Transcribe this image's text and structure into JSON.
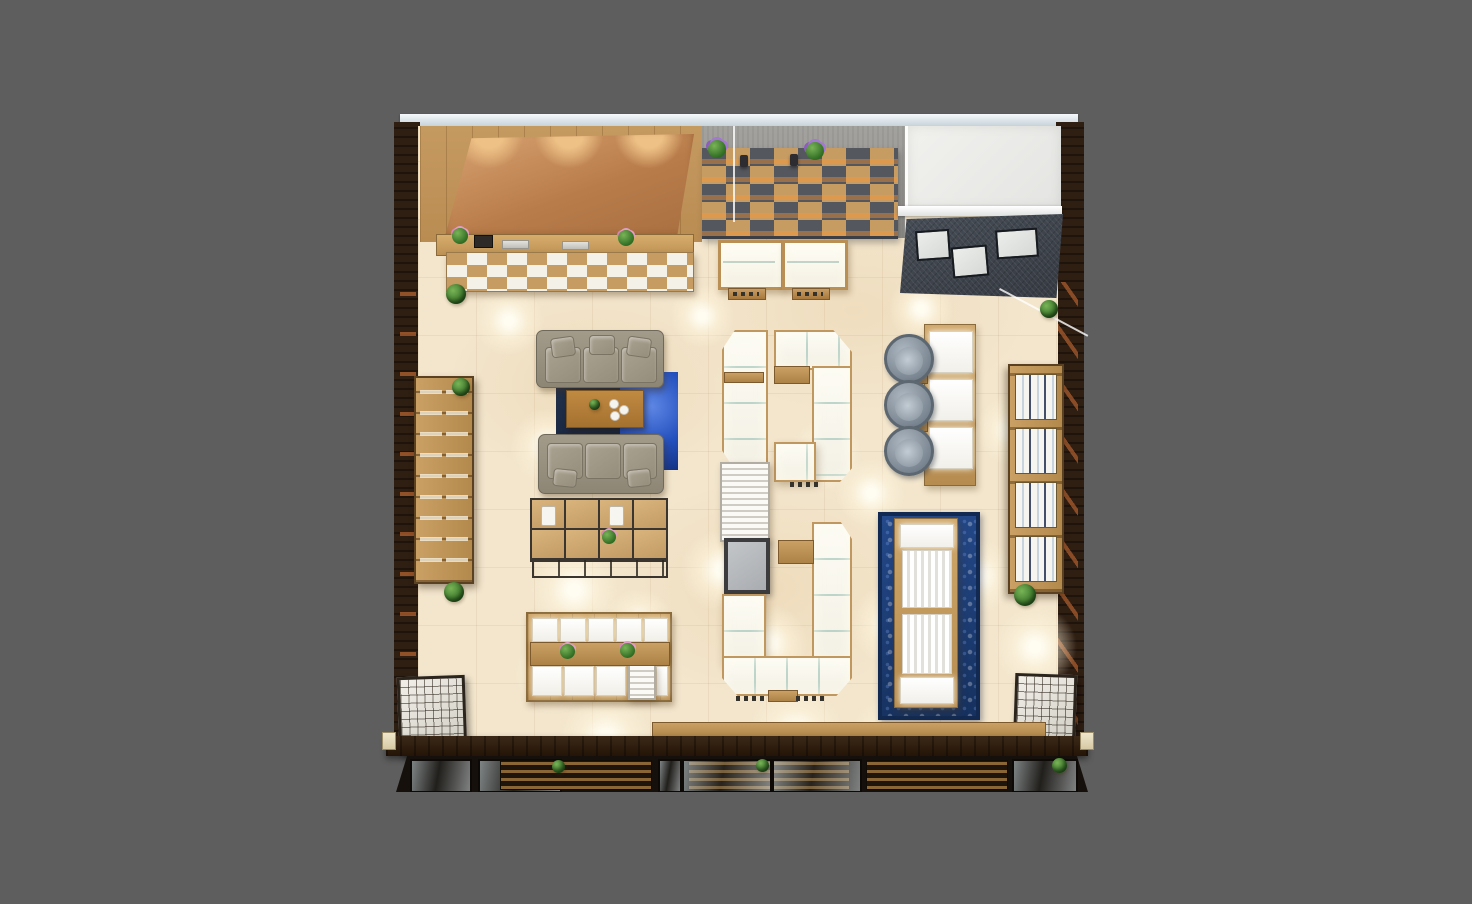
{
  "scene": {
    "type": "3d-floor-plan-render",
    "view": "top-down-birds-eye",
    "subject": "retail showroom interior with display counters, reception, lounge sofas and shelving",
    "background": "plain dark gray matte",
    "text_visible": "none"
  },
  "palette": {
    "canvasBg": "#5e5e5e",
    "edgeLight": "#e9eef2",
    "floor": "#f3e6cd",
    "floorVein": "#e2bd8a",
    "woodLight": "#c79c62",
    "woodMid": "#a8793f",
    "woodDark": "#5f4223",
    "darkWall": "#2f1e12",
    "copper": "#c4895b",
    "copperLit": "#eec287",
    "copperAccent": "#b0602f",
    "concrete": "#9a9a96",
    "slotGray": "#54575d",
    "roof": "#3d434b",
    "white": "#f8f7f2",
    "glow": "#fffef7",
    "sofa": "#98907f",
    "rugNavy": "#1c2940",
    "rugBlue": "#2a55c4",
    "carpet": "#1c3c74",
    "chair": "#8b97a2",
    "green": "#3e7c2c",
    "pink": "#e39cc8",
    "purple": "#a477d2",
    "lattice": "#e4e1d9",
    "glass": "#c9d7db",
    "mirror": "#b7babd"
  },
  "inventory": {
    "reception_counters": 1,
    "copper_feature_walls": 1,
    "checkerboard_shelf_walls": 1,
    "white_back_rooms": 1,
    "sloped_roof_canopies": 1,
    "roof_skylight_panels": 3,
    "glass_display_cases": 2,
    "counter_islands": 4,
    "slat_towers": 1,
    "mirrors": 1,
    "sofas": 2,
    "coffee_tables": 1,
    "area_rugs_blue": 1,
    "display_cube_blocks": 1,
    "display_tables": 1,
    "fitting_chairs": 3,
    "fitting_tables": 1,
    "long_display_platforms": 1,
    "patterned_carpets": 1,
    "tall_wall_shelves": 2,
    "lattice_cubes": 2,
    "potted_plants": 12,
    "storefront_glass_walls": 1
  }
}
